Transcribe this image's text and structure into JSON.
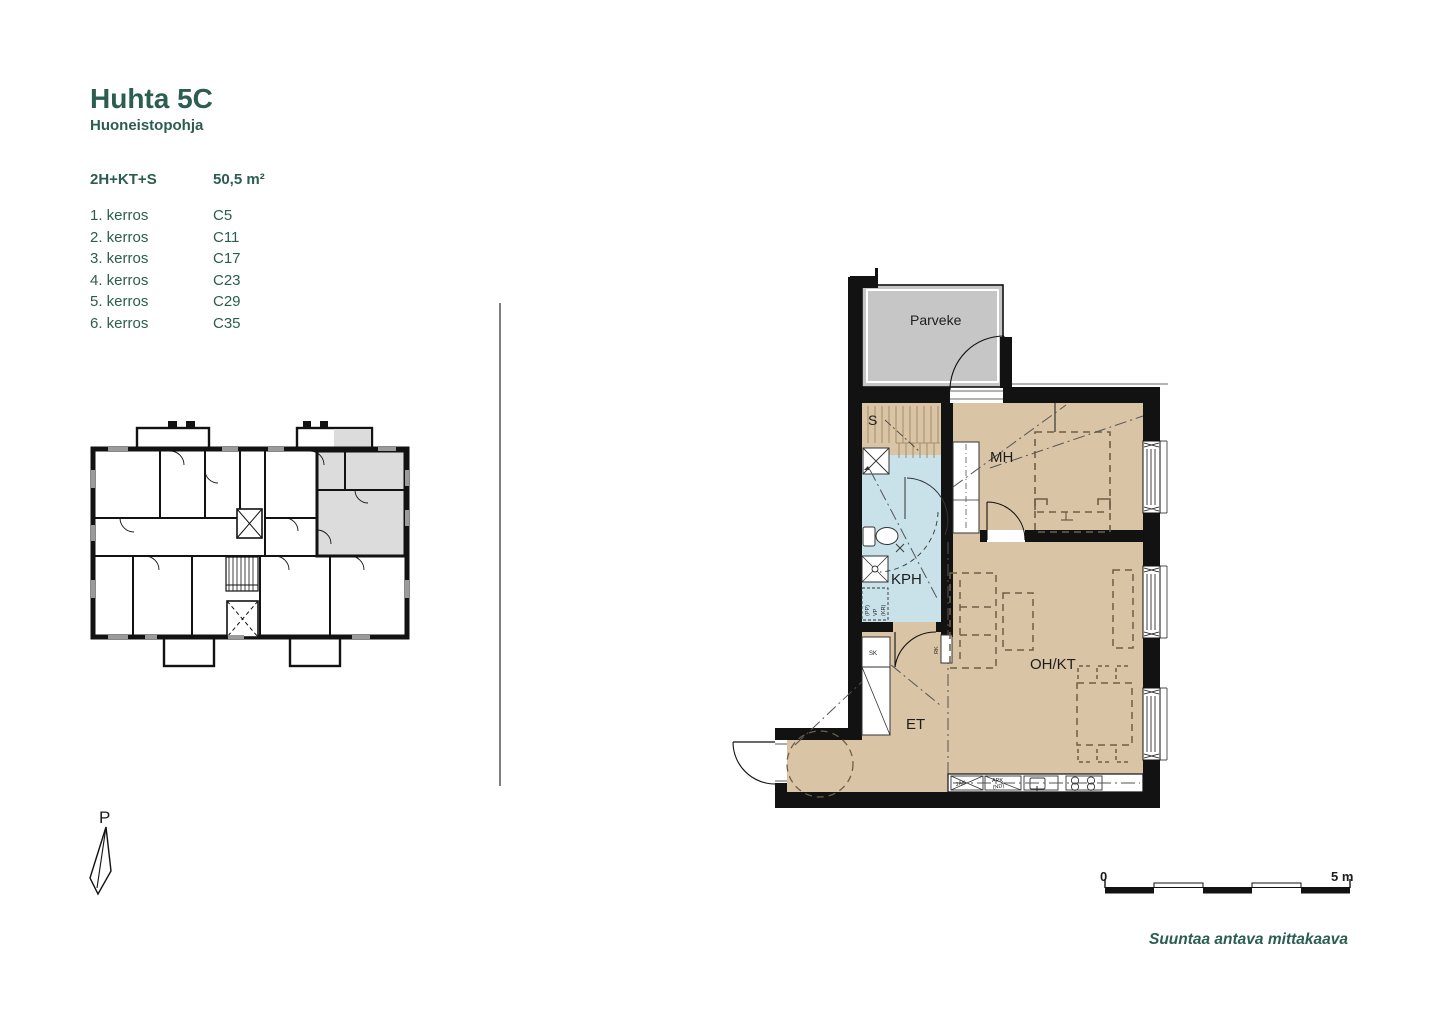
{
  "header": {
    "title": "Huhta 5C",
    "subtitle": "Huoneistopohja"
  },
  "apartment": {
    "type": "2H+KT+S",
    "area": "50,5 m²"
  },
  "floors": [
    {
      "label": "1. kerros",
      "code": "C5"
    },
    {
      "label": "2. kerros",
      "code": "C11"
    },
    {
      "label": "3. kerros",
      "code": "C17"
    },
    {
      "label": "4. kerros",
      "code": "C23"
    },
    {
      "label": "5. kerros",
      "code": "C29"
    },
    {
      "label": "6. kerros",
      "code": "C35"
    }
  ],
  "plan": {
    "rooms": {
      "balcony": "Parveke",
      "sauna": "S",
      "bedroom": "MH",
      "bathroom": "KPH",
      "living_kitchen": "OH/KT",
      "entry": "ET"
    },
    "fixtures": {
      "closet": "SK",
      "electrical_cabinet": "RK",
      "fridge": "JÄK",
      "dishwasher": "APK",
      "dishwasher_note": "(ND)",
      "washer_pp": "(PP)",
      "washer_vp": "VP",
      "washer_kr": "(KR)"
    }
  },
  "compass": {
    "label": "P"
  },
  "scalebar": {
    "start": "0",
    "end": "5 m",
    "caption": "Suuntaa antava mittakaava"
  },
  "colors": {
    "accent_green": "#2b5e50",
    "floor_tan": "#d9c5a6",
    "wet_room_blue": "#c9e2ea",
    "balcony_gray": "#c6c6c6",
    "highlight_gray": "#dcdcdc",
    "wall_black": "#121212"
  }
}
